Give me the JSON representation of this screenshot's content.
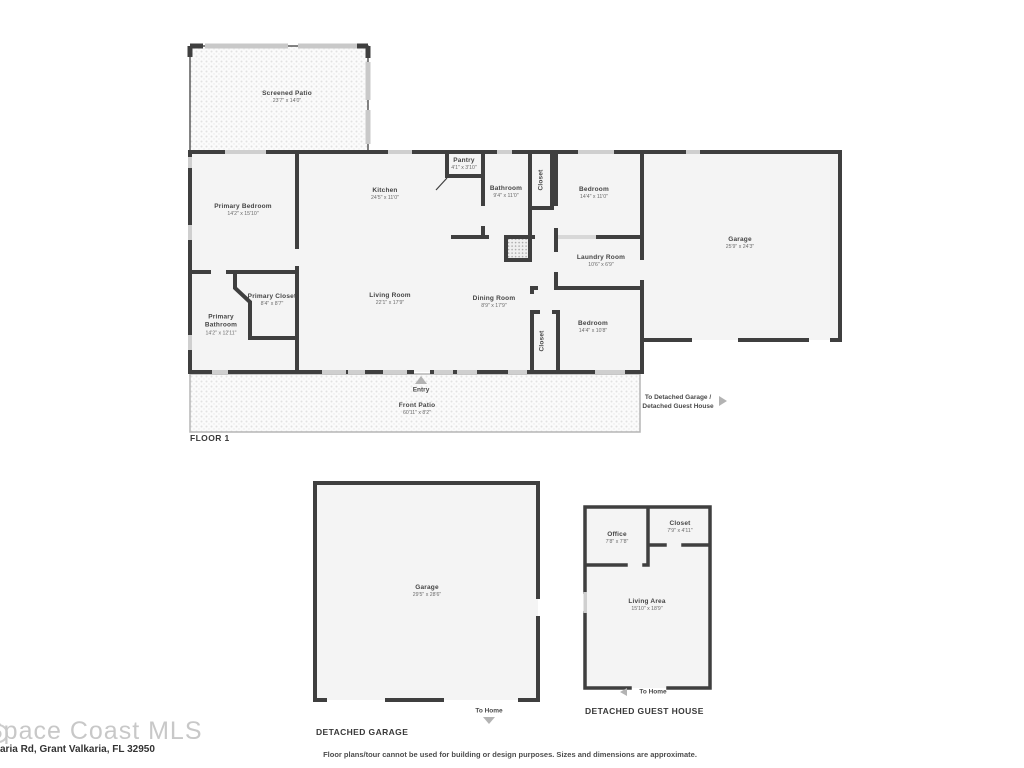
{
  "colors": {
    "wall": "#3f3f3f",
    "room_fill": "#f4f4f4",
    "window": "#cfcfcf",
    "arrow": "#b3b3b3",
    "patio_dot": "#e2e2e2"
  },
  "floor1": {
    "label": "FLOOR 1",
    "entry_label": "Entry",
    "to_detached_line1": "To Detached Garage /",
    "to_detached_line2": "Detached Guest House",
    "rooms": [
      {
        "id": "screened-patio",
        "name": "Screened Patio",
        "dims": "23'7\" x 14'0\""
      },
      {
        "id": "primary-bedroom",
        "name": "Primary Bedroom",
        "dims": "14'2\" x 15'10\""
      },
      {
        "id": "kitchen",
        "name": "Kitchen",
        "dims": "24'5\" x 11'0\""
      },
      {
        "id": "pantry",
        "name": "Pantry",
        "dims": "4'1\" x 3'10\""
      },
      {
        "id": "bathroom",
        "name": "Bathroom",
        "dims": "9'4\" x 11'0\""
      },
      {
        "id": "closet-top",
        "name": "Closet",
        "dims": ""
      },
      {
        "id": "bedroom-top",
        "name": "Bedroom",
        "dims": "14'4\" x 11'0\""
      },
      {
        "id": "garage",
        "name": "Garage",
        "dims": "25'9\" x 24'3\""
      },
      {
        "id": "laundry-room",
        "name": "Laundry Room",
        "dims": "10'6\" x 6'9\""
      },
      {
        "id": "primary-closet",
        "name": "Primary Closet",
        "dims": "8'4\" x 8'7\""
      },
      {
        "id": "primary-bathroom",
        "name": "Primary Bathroom",
        "dims": "14'2\" x 12'11\""
      },
      {
        "id": "living-room",
        "name": "Living Room",
        "dims": "22'1\" x 17'9\""
      },
      {
        "id": "dining-room",
        "name": "Dining Room",
        "dims": "8'9\" x 17'9\""
      },
      {
        "id": "closet-bottom",
        "name": "Closet",
        "dims": ""
      },
      {
        "id": "bedroom-bottom",
        "name": "Bedroom",
        "dims": "14'4\" x 10'8\""
      },
      {
        "id": "front-patio",
        "name": "Front Patio",
        "dims": "60'11\" x 8'2\""
      }
    ]
  },
  "detached_garage": {
    "label": "DETACHED GARAGE",
    "to_home": "To Home",
    "rooms": [
      {
        "id": "garage2",
        "name": "Garage",
        "dims": "29'5\" x 28'6\""
      }
    ]
  },
  "guest_house": {
    "label": "DETACHED GUEST HOUSE",
    "to_home": "To Home",
    "rooms": [
      {
        "id": "office",
        "name": "Office",
        "dims": "7'8\" x 7'8\""
      },
      {
        "id": "closet-gh",
        "name": "Closet",
        "dims": "7'9\" x 4'11\""
      },
      {
        "id": "living-area",
        "name": "Living Area",
        "dims": "15'10\" x 18'9\""
      }
    ]
  },
  "footer": {
    "watermark": "Space Coast MLS",
    "address": "aria Rd, Grant Valkaria, FL 32950",
    "disclaimer": "Floor plans/tour cannot be used for building or design purposes. Sizes and dimensions are approximate."
  }
}
